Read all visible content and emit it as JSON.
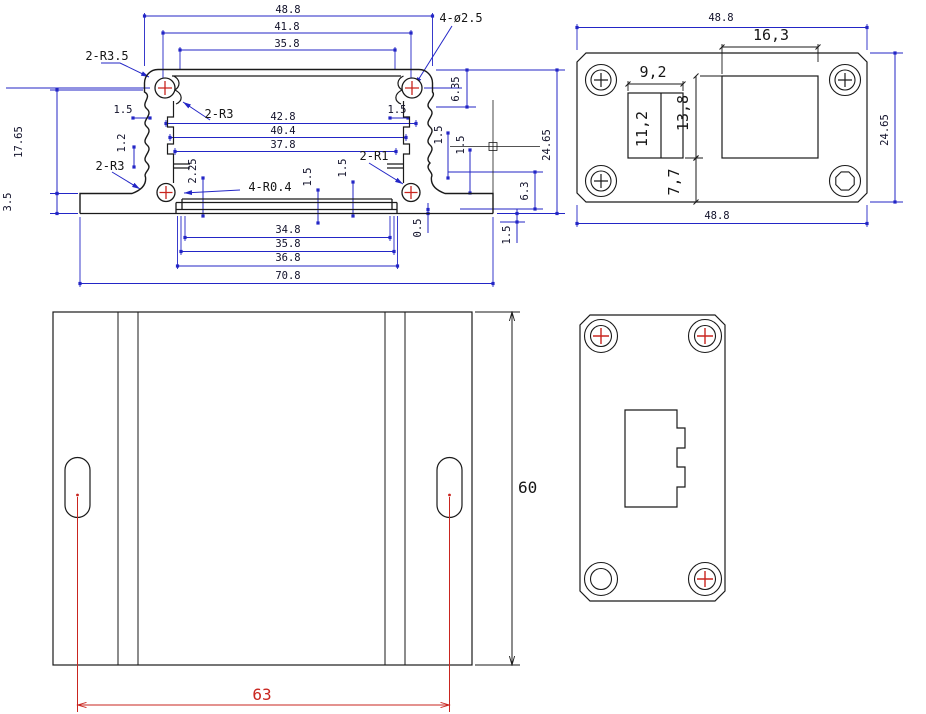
{
  "drawing_type": "mechanical engineering drawing – aluminium enclosure, 4 orthographic views",
  "colors": {
    "outline": "#1a1a1a",
    "dim_line_blue": "#2326c6",
    "dim_line_black": "#1a1a1a",
    "dim_line_red": "#c9251f",
    "cross_red": "#c9251f",
    "label": {
      "d": "#11112a",
      "k": "#161616",
      "r": "#c9251f"
    },
    "background": "#ffffff"
  },
  "views": {
    "section": {
      "labels": [
        {
          "t": "48.8",
          "x": 288,
          "y": 13
        },
        {
          "t": "41.8",
          "x": 287,
          "y": 30
        },
        {
          "t": "35.8",
          "x": 287,
          "y": 47
        },
        {
          "t": "2-R3.5",
          "x": 107,
          "y": 60,
          "c": "k",
          "s": 12
        },
        {
          "t": "4-ø2.5",
          "x": 461,
          "y": 22,
          "c": "k",
          "s": 12
        },
        {
          "t": "2-R3",
          "x": 219,
          "y": 118,
          "c": "k",
          "s": 12
        },
        {
          "t": "1.5",
          "x": 123,
          "y": 113
        },
        {
          "t": "1.2",
          "x": 125,
          "y": 143,
          "rot": -90
        },
        {
          "t": "42.8",
          "x": 283,
          "y": 120
        },
        {
          "t": "40.4",
          "x": 283,
          "y": 134
        },
        {
          "t": "37.8",
          "x": 283,
          "y": 148
        },
        {
          "t": "1.5",
          "x": 397,
          "y": 113
        },
        {
          "t": "1.5",
          "x": 442,
          "y": 135,
          "rot": -90
        },
        {
          "t": "1.5",
          "x": 464,
          "y": 145,
          "rot": -90
        },
        {
          "t": "6.35",
          "x": 459,
          "y": 89,
          "rot": -90
        },
        {
          "t": "24.65",
          "x": 550,
          "y": 145,
          "rot": -90
        },
        {
          "t": "2-R3",
          "x": 110,
          "y": 170,
          "c": "k",
          "s": 12
        },
        {
          "t": "2.25",
          "x": 196,
          "y": 171,
          "rot": -90
        },
        {
          "t": "4-R0.4",
          "x": 270,
          "y": 191,
          "c": "k",
          "s": 12
        },
        {
          "t": "1.5",
          "x": 311,
          "y": 177,
          "rot": -90
        },
        {
          "t": "1.5",
          "x": 346,
          "y": 168,
          "rot": -90
        },
        {
          "t": "2-R1",
          "x": 374,
          "y": 160,
          "c": "k",
          "s": 12
        },
        {
          "t": "6.3",
          "x": 528,
          "y": 191,
          "rot": -90
        },
        {
          "t": "0.5",
          "x": 421,
          "y": 228,
          "rot": -90
        },
        {
          "t": "1.5",
          "x": 510,
          "y": 235,
          "rot": -90
        },
        {
          "t": "34.8",
          "x": 288,
          "y": 233
        },
        {
          "t": "35.8",
          "x": 288,
          "y": 247
        },
        {
          "t": "36.8",
          "x": 288,
          "y": 261
        },
        {
          "t": "70.8",
          "x": 288,
          "y": 279
        },
        {
          "t": "17.65",
          "x": 22,
          "y": 142,
          "rot": -90
        },
        {
          "t": "3.5",
          "x": 11,
          "y": 202,
          "rot": -90
        }
      ]
    },
    "end_cap": {
      "labels": [
        {
          "t": "48.8",
          "x": 721,
          "y": 21
        },
        {
          "t": "16,3",
          "x": 771,
          "y": 40,
          "c": "k",
          "s": 15
        },
        {
          "t": "9,2",
          "x": 653,
          "y": 77,
          "c": "k",
          "s": 15
        },
        {
          "t": "11,2",
          "x": 647,
          "y": 129,
          "rot": -90,
          "c": "k",
          "s": 15
        },
        {
          "t": "13,8",
          "x": 688,
          "y": 113,
          "rot": -90,
          "c": "k",
          "s": 15
        },
        {
          "t": "7,7",
          "x": 679,
          "y": 182,
          "rot": -90,
          "c": "k",
          "s": 15
        },
        {
          "t": "48.8",
          "x": 717,
          "y": 219
        },
        {
          "t": "24.65",
          "x": 888,
          "y": 130,
          "rot": -90
        }
      ]
    },
    "plan": {
      "labels": [
        {
          "t": "60",
          "x": 518,
          "y": 493,
          "c": "k",
          "s": 16,
          "a": "start"
        },
        {
          "t": "63",
          "x": 262,
          "y": 700,
          "c": "r",
          "s": 16
        }
      ]
    },
    "end_panel": {
      "labels": []
    }
  }
}
